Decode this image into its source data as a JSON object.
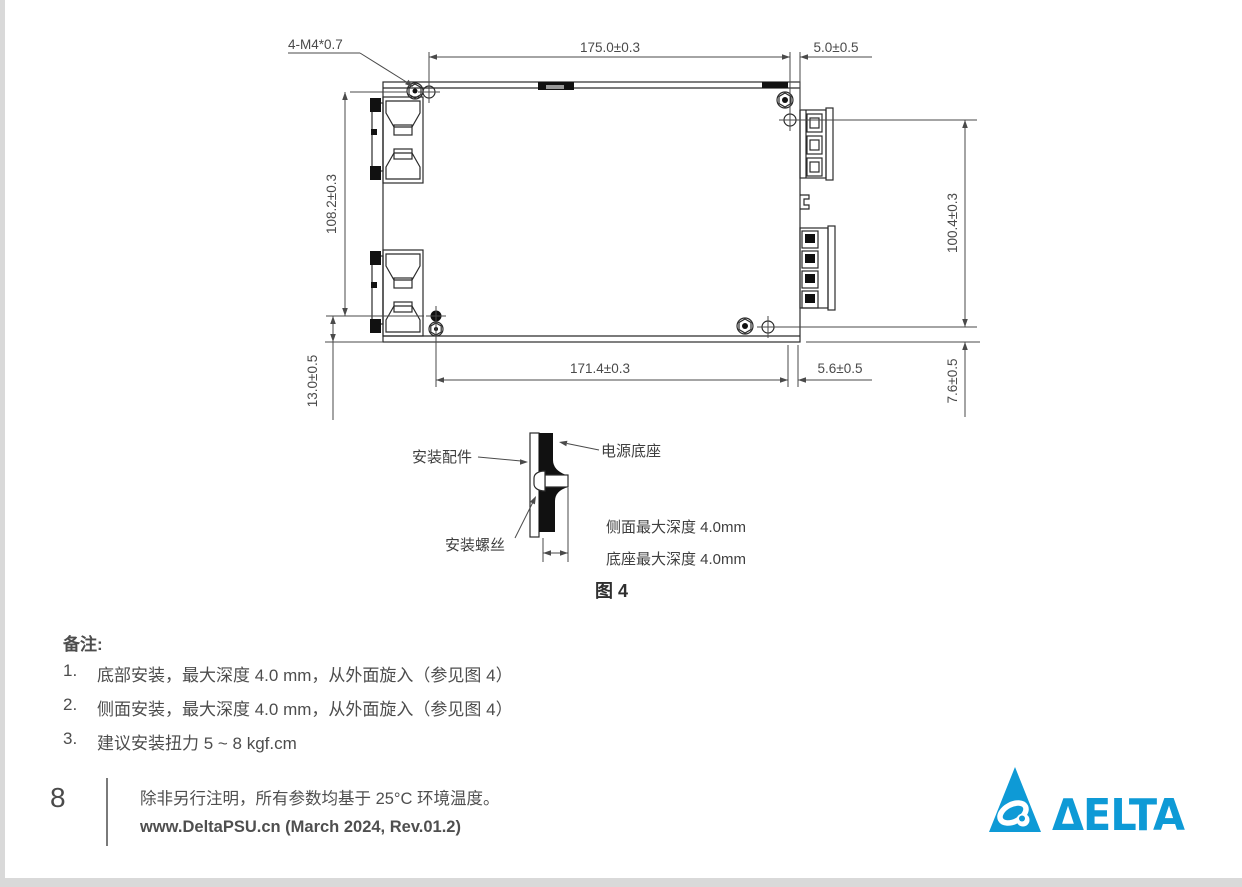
{
  "drawing": {
    "thread_label": "4-M4*0.7",
    "dim_top_width": "175.0±0.3",
    "dim_top_right": "5.0±0.5",
    "dim_left_height": "108.2±0.3",
    "dim_left_bottom": "13.0±0.5",
    "dim_bottom_width": "171.4±0.3",
    "dim_bottom_right": "5.6±0.5",
    "dim_right_height": "100.4±0.3",
    "dim_right_bottom": "7.6±0.5"
  },
  "figure": {
    "caption": "图 4",
    "label_accessory": "安装配件",
    "label_base": "电源底座",
    "label_screw": "安装螺丝",
    "label_side_depth": "侧面最大深度 4.0mm",
    "label_bottom_depth": "底座最大深度 4.0mm"
  },
  "notes": {
    "heading": "备注:",
    "items": [
      {
        "num": "1.",
        "text": "底部安装，最大深度 4.0 mm，从外面旋入（参见图 4）"
      },
      {
        "num": "2.",
        "text": "侧面安装，最大深度 4.0 mm，从外面旋入（参见图 4）"
      },
      {
        "num": "3.",
        "text": "建议安装扭力 5 ~ 8 kgf.cm"
      }
    ]
  },
  "footer": {
    "page_number": "8",
    "note": "除非另行注明，所有参数均基于 25°C 环境温度。",
    "source": "www.DeltaPSU.cn (March 2024, Rev.01.2)",
    "brand": "DELTA",
    "logo_text": "ΔELTA",
    "brand_color": "#0e9ad6"
  }
}
